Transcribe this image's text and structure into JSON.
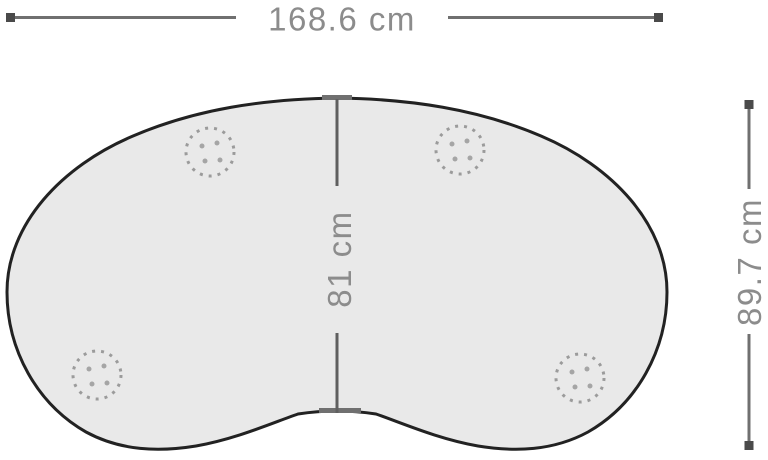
{
  "diagram": {
    "type": "furniture-dimension-drawing",
    "shape": "kidney-shaped table top",
    "dimensions": {
      "width": {
        "label": "168.6 cm",
        "value": 168.6,
        "unit": "cm",
        "position": "top"
      },
      "center_depth": {
        "label": "81 cm",
        "value": 81,
        "unit": "cm",
        "position": "center-vertical"
      },
      "total_depth": {
        "label": "89.7 cm",
        "value": 89.7,
        "unit": "cm",
        "position": "right"
      }
    },
    "leg_markers_count": 4,
    "colors": {
      "outline": "#222222",
      "fill": "#e9e9e9",
      "dimension_line": "#707070",
      "dimension_endcap": "#4a4a4a",
      "dimension_text": "#8c8c8c",
      "leg_marker": "#9b9b9b",
      "background": "#ffffff"
    }
  }
}
